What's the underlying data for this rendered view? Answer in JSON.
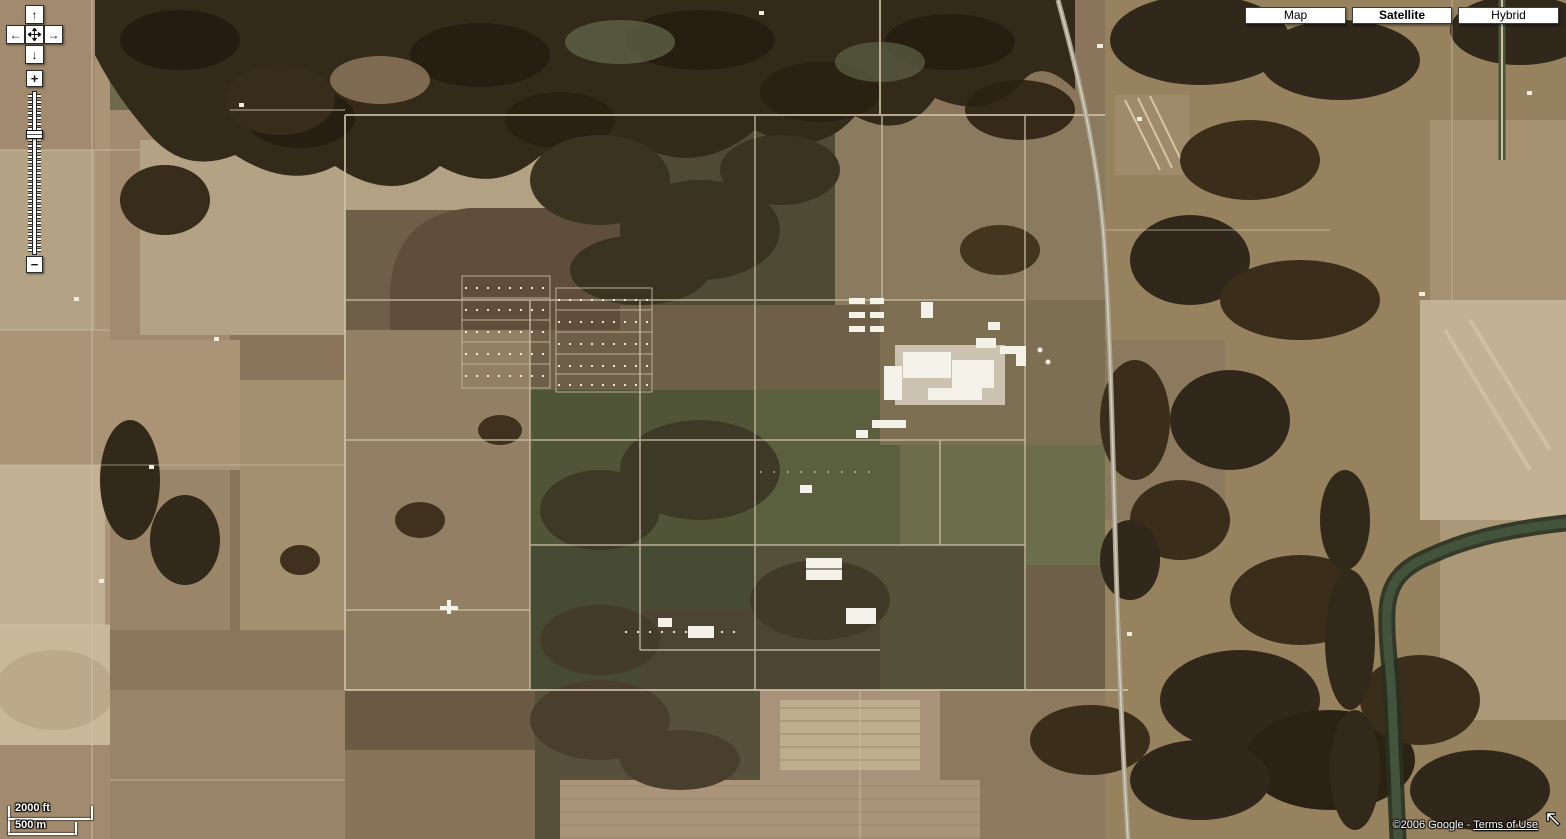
{
  "map_type_buttons": [
    {
      "label": "Map",
      "active": false
    },
    {
      "label": "Satellite",
      "active": true
    },
    {
      "label": "Hybrid",
      "active": false
    }
  ],
  "pan_control": {
    "up": "↑",
    "down": "↓",
    "left": "←",
    "right": "→"
  },
  "zoom_control": {
    "zoom_in": "+",
    "zoom_out": "−"
  },
  "scale_bar": {
    "imperial_label": "2000 ft",
    "metric_label": "500 m"
  },
  "attribution": {
    "copyright_text": "©2006 Google",
    "separator": " - ",
    "terms_of_use_label": "Terms of Use"
  },
  "colors": {
    "control_button_bg": "#ffffff",
    "control_button_border": "#2b2b2b",
    "scale_text": "#ffffff",
    "attribution_text": "#ffffff",
    "field_tan": "#9c8569",
    "field_pale": "#c2b192",
    "forest_dark": "#2b2214",
    "olive_field": "#5e6246",
    "river": "#44543c",
    "road": "#cdc2a8",
    "plant_buildings": "#f4f1e8"
  }
}
